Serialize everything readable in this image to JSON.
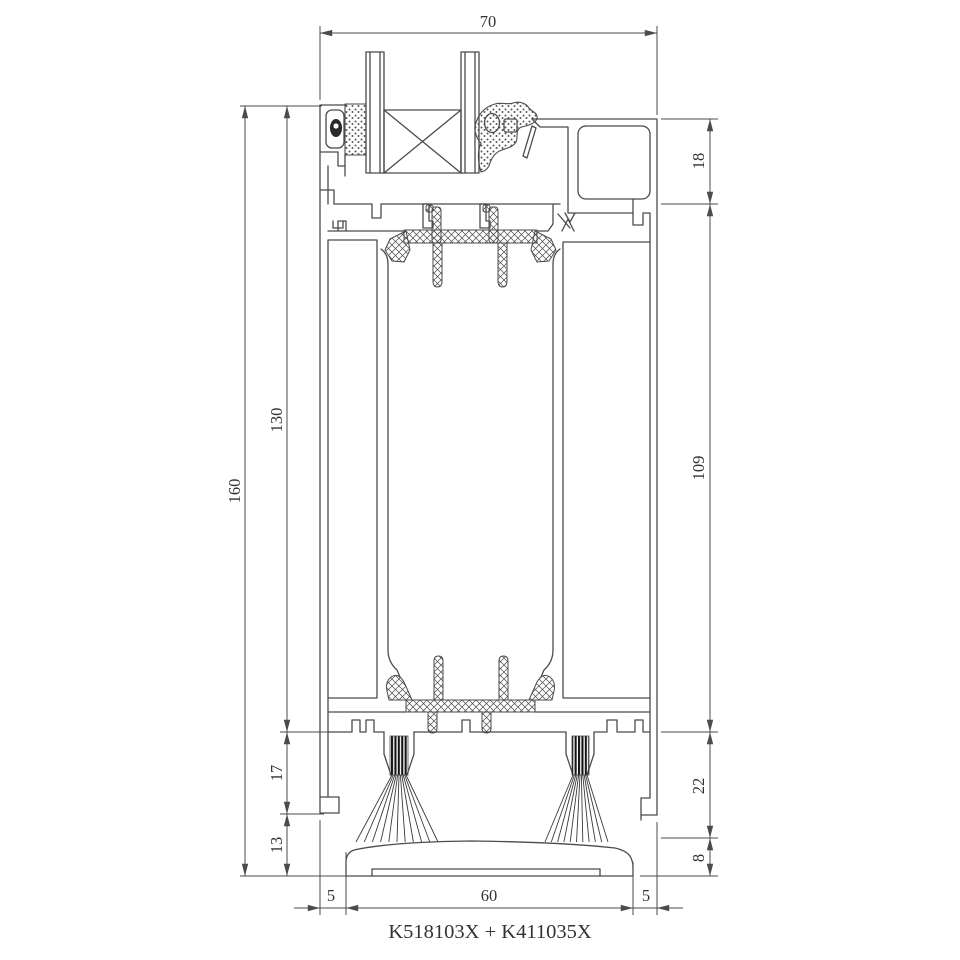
{
  "drawing": {
    "part_label": "K518103X + K411035X",
    "dims": {
      "total_width": "70",
      "total_height": "160",
      "frame_height": "130",
      "brush_height": "17",
      "gap_height": "13",
      "top_right_height": "18",
      "body_height": "109",
      "lower_right_height": "22",
      "sill_height": "8",
      "sill_offset_left": "5",
      "sill_width": "60",
      "sill_offset_right": "5"
    },
    "colors": {
      "background": "#ffffff",
      "line": "#4b4b4b",
      "text": "#333333",
      "bristle": "#141414"
    }
  }
}
